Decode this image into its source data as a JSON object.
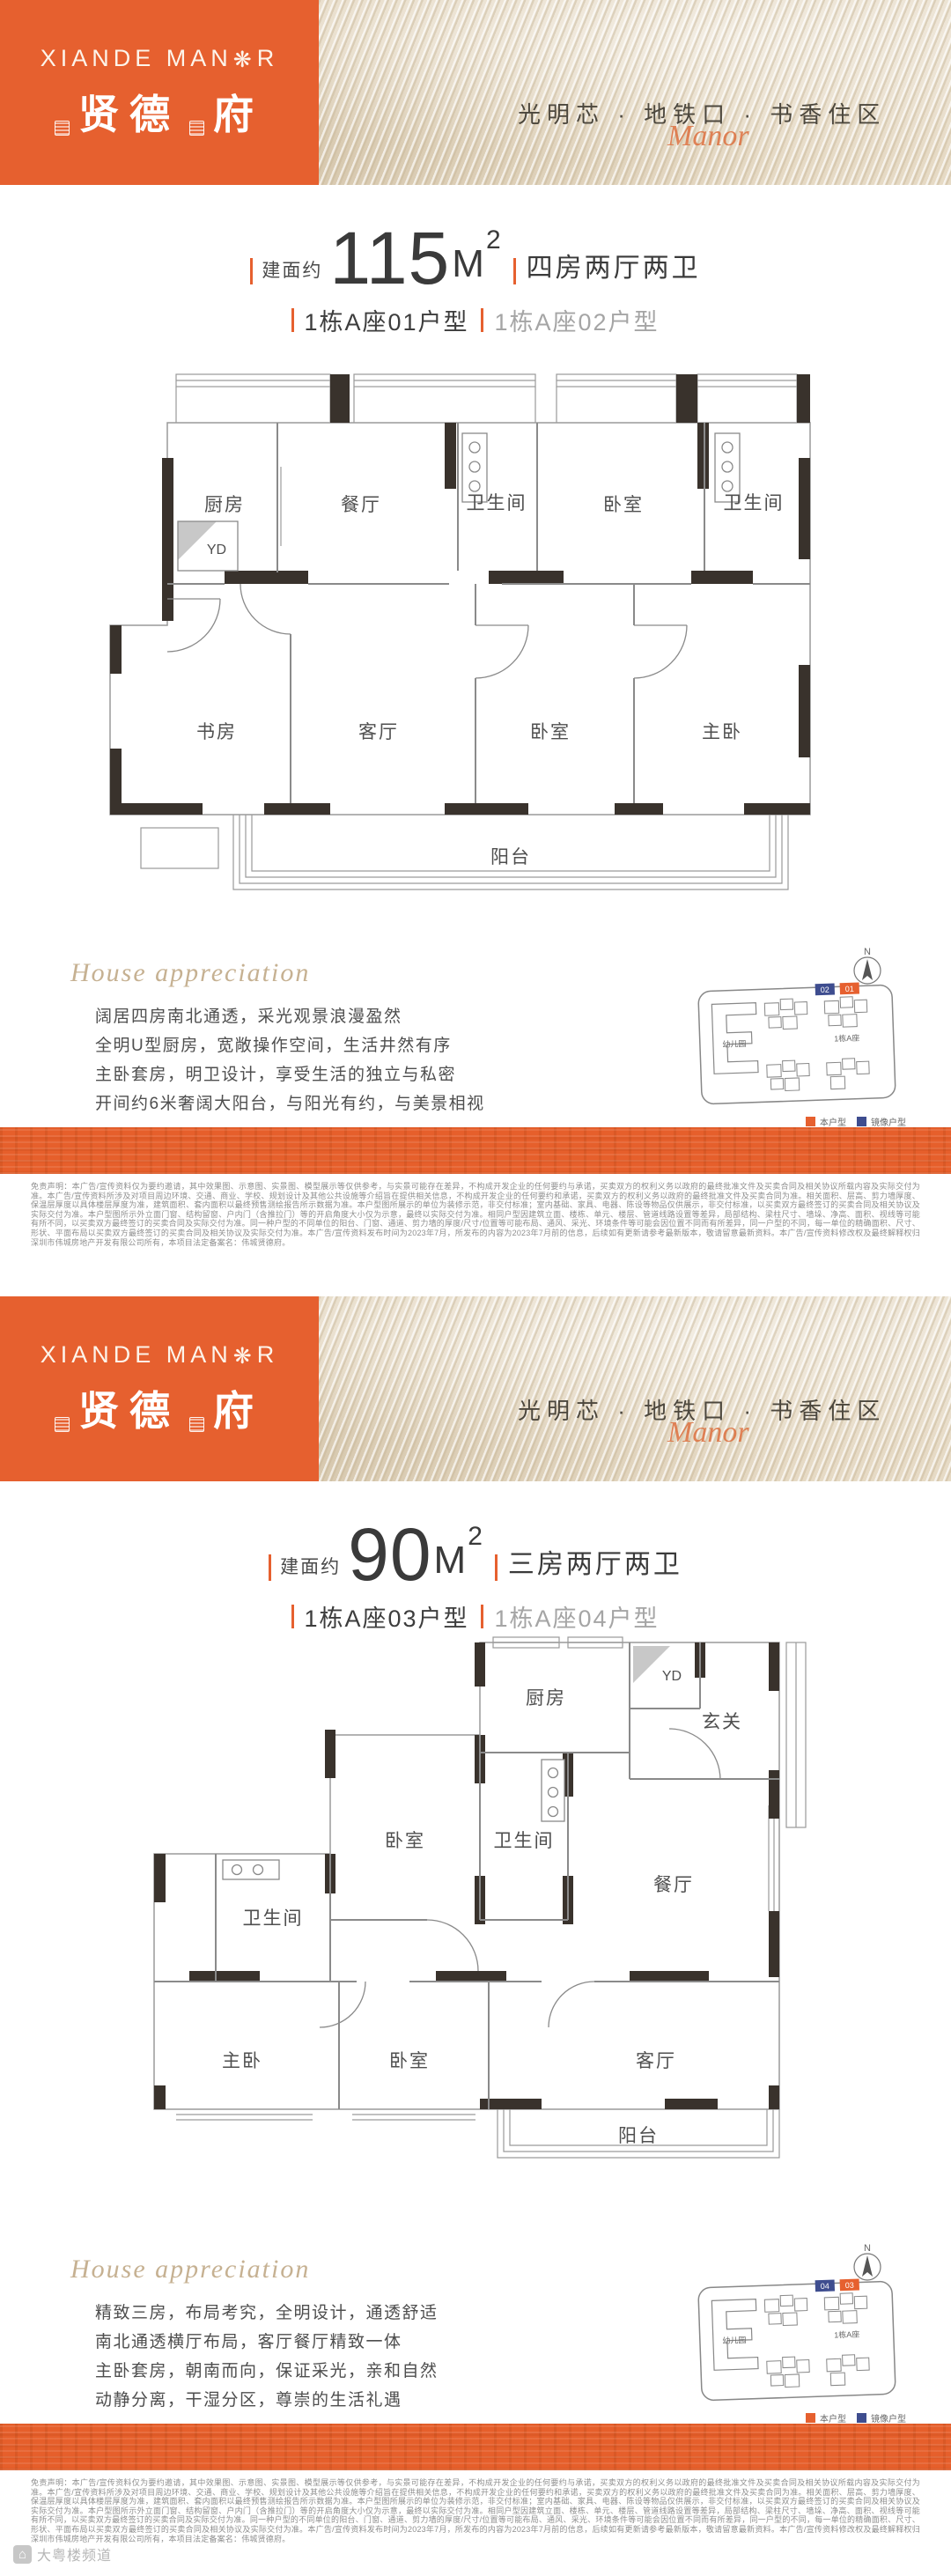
{
  "brand": {
    "logo_en_pre": "XIANDE MAN",
    "logo_rosette": "❋",
    "logo_en_post": "R",
    "logo_cn_a": "贤德",
    "logo_cn_b": "府",
    "tagline": "光明芯 · 地铁口 · 书香住区",
    "tagline_script": "Manor",
    "accent_color": "#e6602f"
  },
  "sections": [
    {
      "title": {
        "prefix": "建面约",
        "area": "115",
        "unit": "M",
        "sup": "2",
        "type": "四房两厅两卫",
        "unit_a": "1栋A座01户型",
        "unit_b": "1栋A座02户型"
      },
      "rooms": {
        "kitchen": "厨房",
        "dining": "餐厅",
        "bath1": "卫生间",
        "bedroom1": "卧室",
        "bath2": "卫生间",
        "study": "书房",
        "living": "客厅",
        "bedroom2": "卧室",
        "master": "主卧",
        "balcony": "阳台",
        "yd": "YD"
      },
      "appreciation": {
        "heading": "House appreciation",
        "lines": [
          "阔居四房南北通透，采光观景浪漫盈然",
          "全明U型厨房，宽敞操作空间，生活井然有序",
          "主卧套房，明卫设计，享受生活的独立与私密",
          "开间约6米奢阔大阳台，与阳光有约，与美景相视"
        ]
      },
      "siteplan": {
        "north": "N",
        "kindergarten": "幼儿园",
        "building": "1栋A座",
        "tag_mirror": "02",
        "tag_this": "01",
        "legend_this": "本户型",
        "legend_mirror": "镜像户型"
      }
    },
    {
      "title": {
        "prefix": "建面约",
        "area": "90",
        "unit": "M",
        "sup": "2",
        "type": "三房两厅两卫",
        "unit_a": "1栋A座03户型",
        "unit_b": "1栋A座04户型"
      },
      "rooms": {
        "kitchen": "厨房",
        "yd": "YD",
        "foyer": "玄关",
        "bedroom1": "卧室",
        "bath1": "卫生间",
        "dining": "餐厅",
        "bath2": "卫生间",
        "master": "主卧",
        "bedroom2": "卧室",
        "living": "客厅",
        "balcony": "阳台"
      },
      "appreciation": {
        "heading": "House appreciation",
        "lines": [
          "精致三房，布局考究，全明设计，通透舒适",
          "南北通透横厅布局，客厅餐厅精致一体",
          "主卧套房，朝南而向，保证采光，亲和自然",
          "动静分离，干湿分区，尊崇的生活礼遇"
        ]
      },
      "siteplan": {
        "north": "N",
        "kindergarten": "幼儿园",
        "building": "1栋A座",
        "tag_mirror": "04",
        "tag_this": "03",
        "legend_this": "本户型",
        "legend_mirror": "镜像户型"
      }
    }
  ],
  "disclaimer": "免责声明：本广告/宣传资料仅为要约邀请，其中效果图、示意图、实景图、模型展示等仅供参考，与实景可能存在差异，不构成开发企业的任何要约与承诺，买卖双方的权利义务以政府的最终批准文件及买卖合同及相关协议所载内容及实际交付为准。本广告/宣传资料所涉及对项目周边环境、交通、商业、学校、规划设计及其他公共设施等介绍旨在提供相关信息，不构成开发企业的任何要约和承诺，买卖双方的权利义务以政府的最终批准文件及买卖合同为准。相关面积、层高、剪力墙厚度、保温层厚度以具体楼层厚度为准，建筑面积、套内面积以最终预售测绘报告所示数据为准。本户型图所展示的单位为装修示范，非交付标准；室内基础、家具、电器、陈设等物品仅供展示，非交付标准，以买卖双方最终签订的买卖合同及相关协议及实际交付为准。本户型图所示外立面门窗、结构留窗、户内门（含推拉门）等的开启角度大小仅为示意，最终以实际交付为准。相同户型因建筑立面、楼栋、单元、楼层、管道线路设置等差异，局部结构、梁柱尺寸、墙垛、净高、面积、视线等可能有所不同，以买卖双方最终签订的买卖合同及实际交付为准。同一种户型的不同单位的阳台、门窗、通道、剪力墙的厚度/尺寸/位置等可能布局、通风、采光、环境条件等可能会因位置不同而有所差异，同一户型的不同，每一单位的精确面积、尺寸、形状、平面布局以买卖双方最终签订的买卖合同及相关协议及实际交付为准。本广告/宣传资料发布时间为2023年7月，所发布的内容为2023年7月前的信息，后续如有更新请参考最新版本，敬请留意最新资料。本广告/宣传资料修改权及最终解释权归深圳市伟城房地产开发有限公司所有，本项目法定备案名：伟城贤德府。",
  "watermark": "大粤楼频道"
}
